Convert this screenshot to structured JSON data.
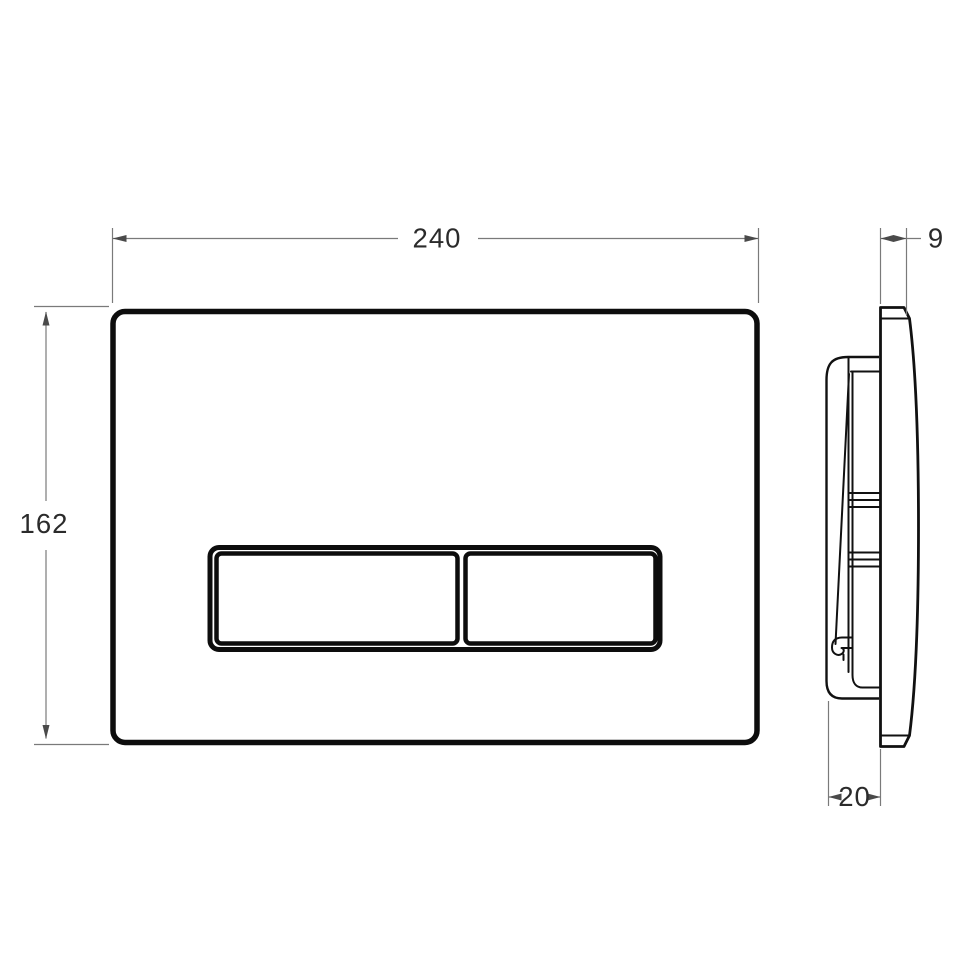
{
  "page": {
    "background": "#ffffff"
  },
  "drawing": {
    "type": "technical-dimension-drawing",
    "subject": "dual-flush wall control plate, front view and side profile view",
    "views": {
      "front": {
        "width_dim": "240",
        "height_dim": "162"
      },
      "side": {
        "thickness_dim": "9",
        "depth_dim": "20"
      }
    },
    "colors": {
      "outline": "#0d0d0d",
      "dimension_line": "#7a7a7a",
      "dimension_text": "#2b2b2b",
      "background": "#ffffff"
    }
  }
}
